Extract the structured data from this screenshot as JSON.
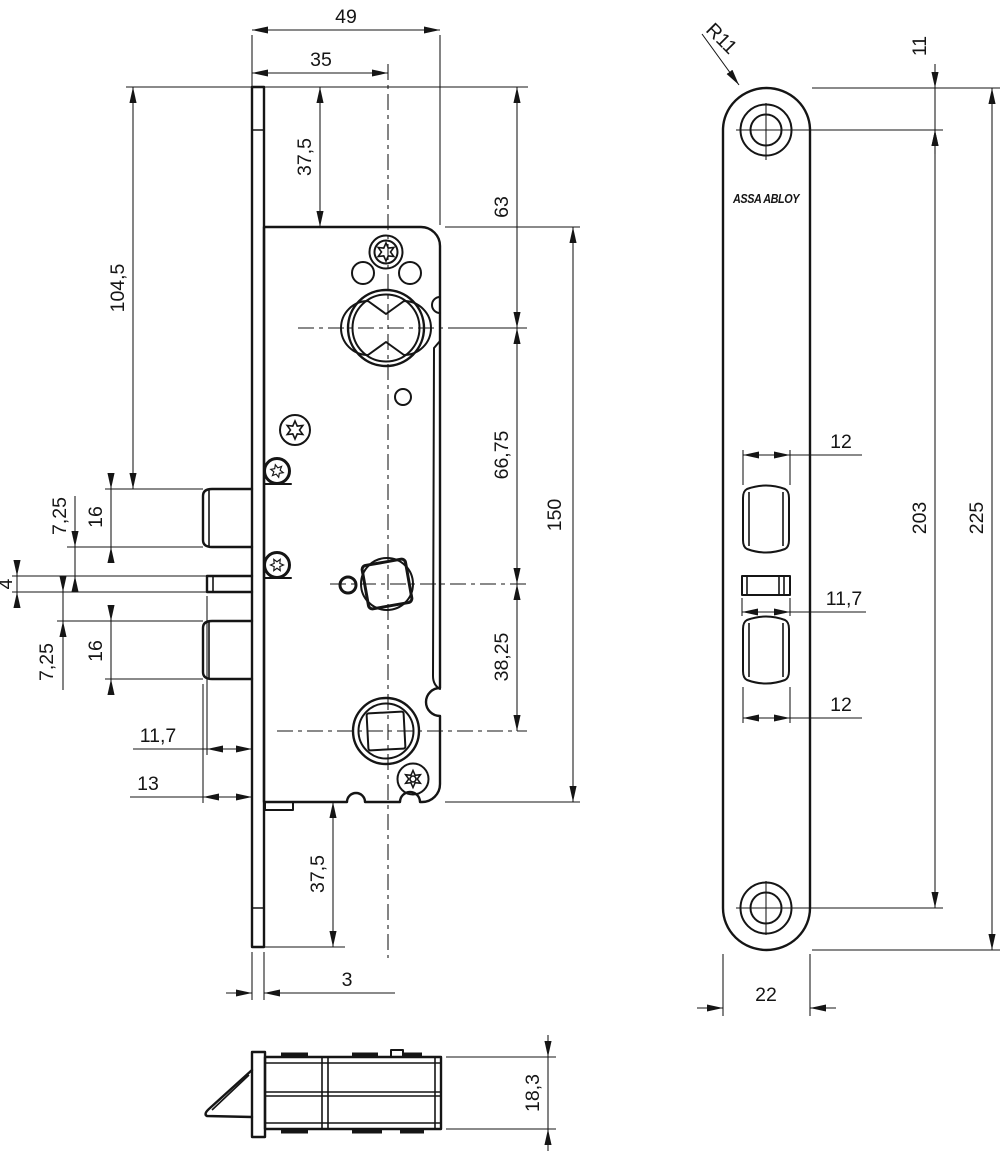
{
  "drawing_title": "Mortise lock dimensional drawing",
  "brand_label": "ASSA ABLOY",
  "colors": {
    "ink": "#151515",
    "background": "#ffffff"
  },
  "front_view": {
    "dim_width_total": "49",
    "dim_backset": "35",
    "dim_top_offset": "37,5",
    "dim_top_to_cylinder": "63",
    "dim_top_to_latch": "104,5",
    "dim_cylinder_to_spindle": "66,75",
    "dim_case_height": "150",
    "dim_gap_upper": "7,25",
    "dim_latch_height_upper": "16",
    "dim_aux_bar_height": "4",
    "dim_gap_lower": "7,25",
    "dim_latch_height_lower": "16",
    "dim_spindle_to_lower": "38,25",
    "dim_aux_protrusion": "11,7",
    "dim_latch_protrusion": "13",
    "dim_bottom_offset": "37,5",
    "dim_faceplate_thickness": "3"
  },
  "faceplate_view": {
    "dim_corner_radius": "R11",
    "dim_top_to_hole": "11",
    "dim_upper_opening_width": "12",
    "dim_hole_spacing": "203",
    "dim_plate_length": "225",
    "dim_aux_opening_width": "11,7",
    "dim_lower_opening_width": "12",
    "dim_plate_width": "22"
  },
  "side_view": {
    "dim_case_depth": "18,3"
  }
}
